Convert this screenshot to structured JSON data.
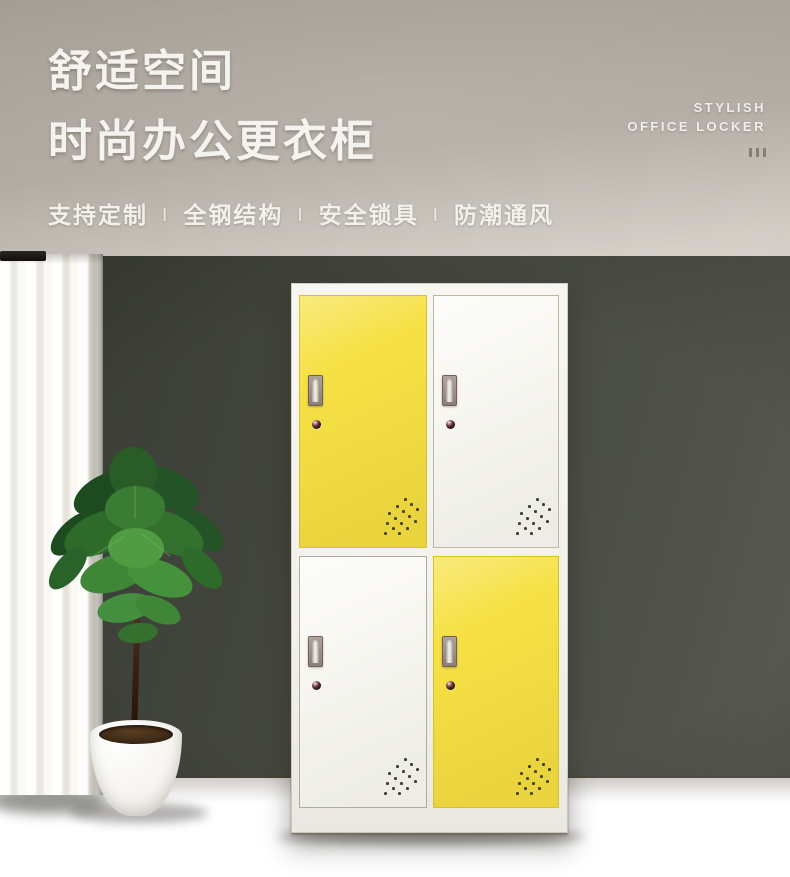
{
  "page": {
    "type": "product-promo-banner",
    "language": "zh-CN"
  },
  "hero": {
    "title_line1": "舒适空间",
    "title_line2": "时尚办公更衣柜",
    "features": [
      "支持定制",
      "全钢结构",
      "安全锁具",
      "防潮通风"
    ],
    "feature_separator": "Ⅰ",
    "tagline_line1": "STYLISH",
    "tagline_line2": "OFFICE LOCKER",
    "tick_marks": 3
  },
  "scene": {
    "locker": {
      "description": "four-door steel office locker, 2x2 checkerboard of yellow and white doors, each with recessed handle, cam lock and corner vent holes",
      "frame_color": "#f3f2ed",
      "doors": [
        {
          "position": "top-left",
          "color_name": "yellow",
          "color": "#f6e145",
          "border": "#d9c12e"
        },
        {
          "position": "top-right",
          "color_name": "white",
          "color": "#f9f8f3",
          "border": "#bdb99f"
        },
        {
          "position": "bottom-left",
          "color_name": "white",
          "color": "#f9f8f3",
          "border": "#aeaba0"
        },
        {
          "position": "bottom-right",
          "color_name": "yellow",
          "color": "#f6e145",
          "border": "#d9c12e"
        }
      ]
    },
    "palette": {
      "banner_top": "#a49d94",
      "banner_bottom": "#d7d3cb",
      "wall_dark": "#383b33",
      "wall_light": "#565850",
      "floor": "#dbca a8",
      "floor_fixed": "#dbcaa8",
      "accent_yellow": "#f6e145",
      "text_light": "#f4f3ef"
    }
  }
}
